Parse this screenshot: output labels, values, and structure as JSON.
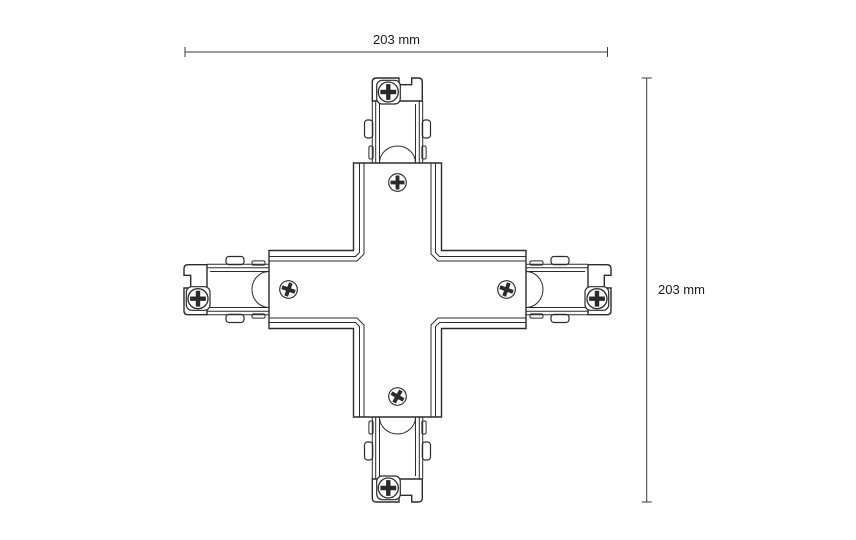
{
  "drawing": {
    "kind": "technical-dimension-drawing",
    "dimensions": {
      "width": {
        "label": "203 mm"
      },
      "height": {
        "label": "203 mm"
      }
    },
    "icons": {
      "screws": "phillips-screw-icon"
    }
  },
  "colors": {
    "background": "#ffffff",
    "line": "#2b2b2b",
    "dimension_line": "#3a3a3a",
    "text": "#1a1a1a"
  }
}
